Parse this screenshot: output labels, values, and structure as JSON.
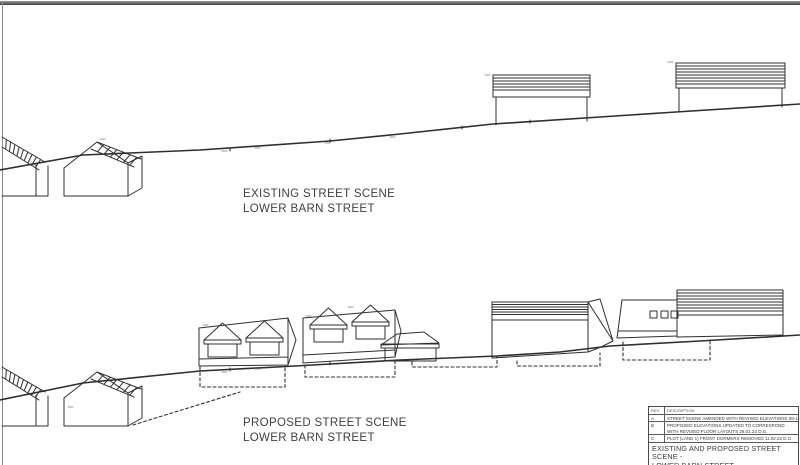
{
  "sheet": {
    "existing_scene": {
      "label_line1": "EXISTING STREET SCENE",
      "label_line2": "LOWER BARN STREET"
    },
    "proposed_scene": {
      "label_line1": "PROPOSED STREET SCENE",
      "label_line2": "LOWER BARN STREET"
    },
    "title_block": {
      "rev_col_header": "REV",
      "desc_col_header": "DESCRIPTION",
      "revisions": [
        {
          "rev": "A",
          "description": "STREET SCENE AMENDED WITH REVISED ELEVATIONS 08-11-21 D.G."
        },
        {
          "rev": "B",
          "description": "PROPOSED ELEVATIONS UPDATED TO CORRESPOND WITH REVISED FLOOR LAYOUTS 28.01.22 D.G."
        },
        {
          "rev": "C",
          "description": "PLOT (LAND 1) FRONT DORMERS REMOVED 11.02.22 D.G."
        }
      ],
      "drawing_title_line1": "EXISTING AND PROPOSED STREET SCENE -",
      "drawing_title_line2": "LOWER BARN STREET"
    },
    "colors": {
      "line": "#2f2f2f",
      "text": "#3f3f3f",
      "top_bar": "#4a4a4a",
      "background": "#ffffff"
    }
  }
}
